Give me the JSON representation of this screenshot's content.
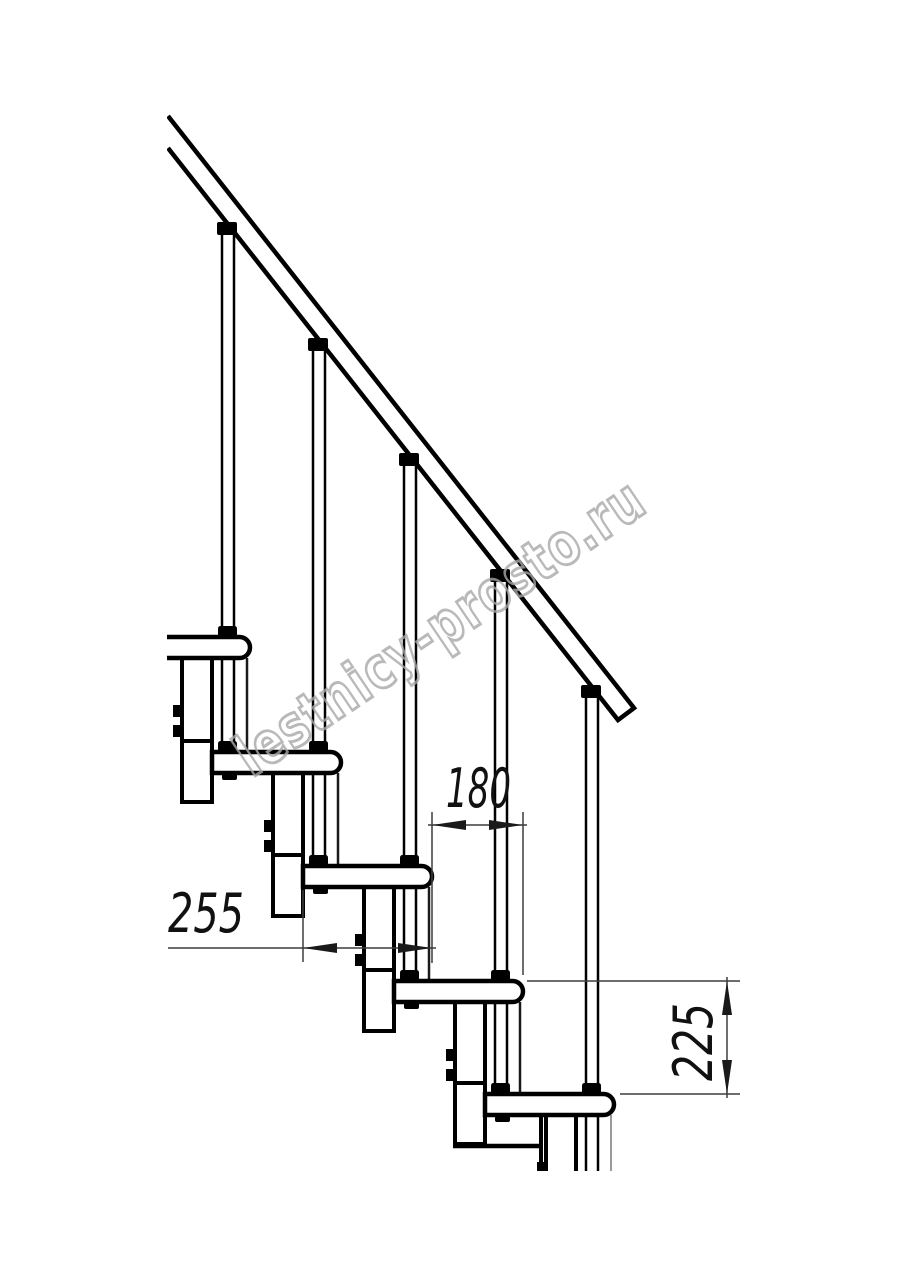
{
  "drawing": {
    "watermark": "lestnicy-prosto.ru",
    "dimensions": {
      "tread_depth": {
        "label": "255"
      },
      "step_offset": {
        "label": "180"
      },
      "step_rise": {
        "label": "225"
      }
    },
    "colors": {
      "line": "#000000",
      "thin_line": "#3d3d3d",
      "watermark": "#a8a8a8"
    }
  }
}
